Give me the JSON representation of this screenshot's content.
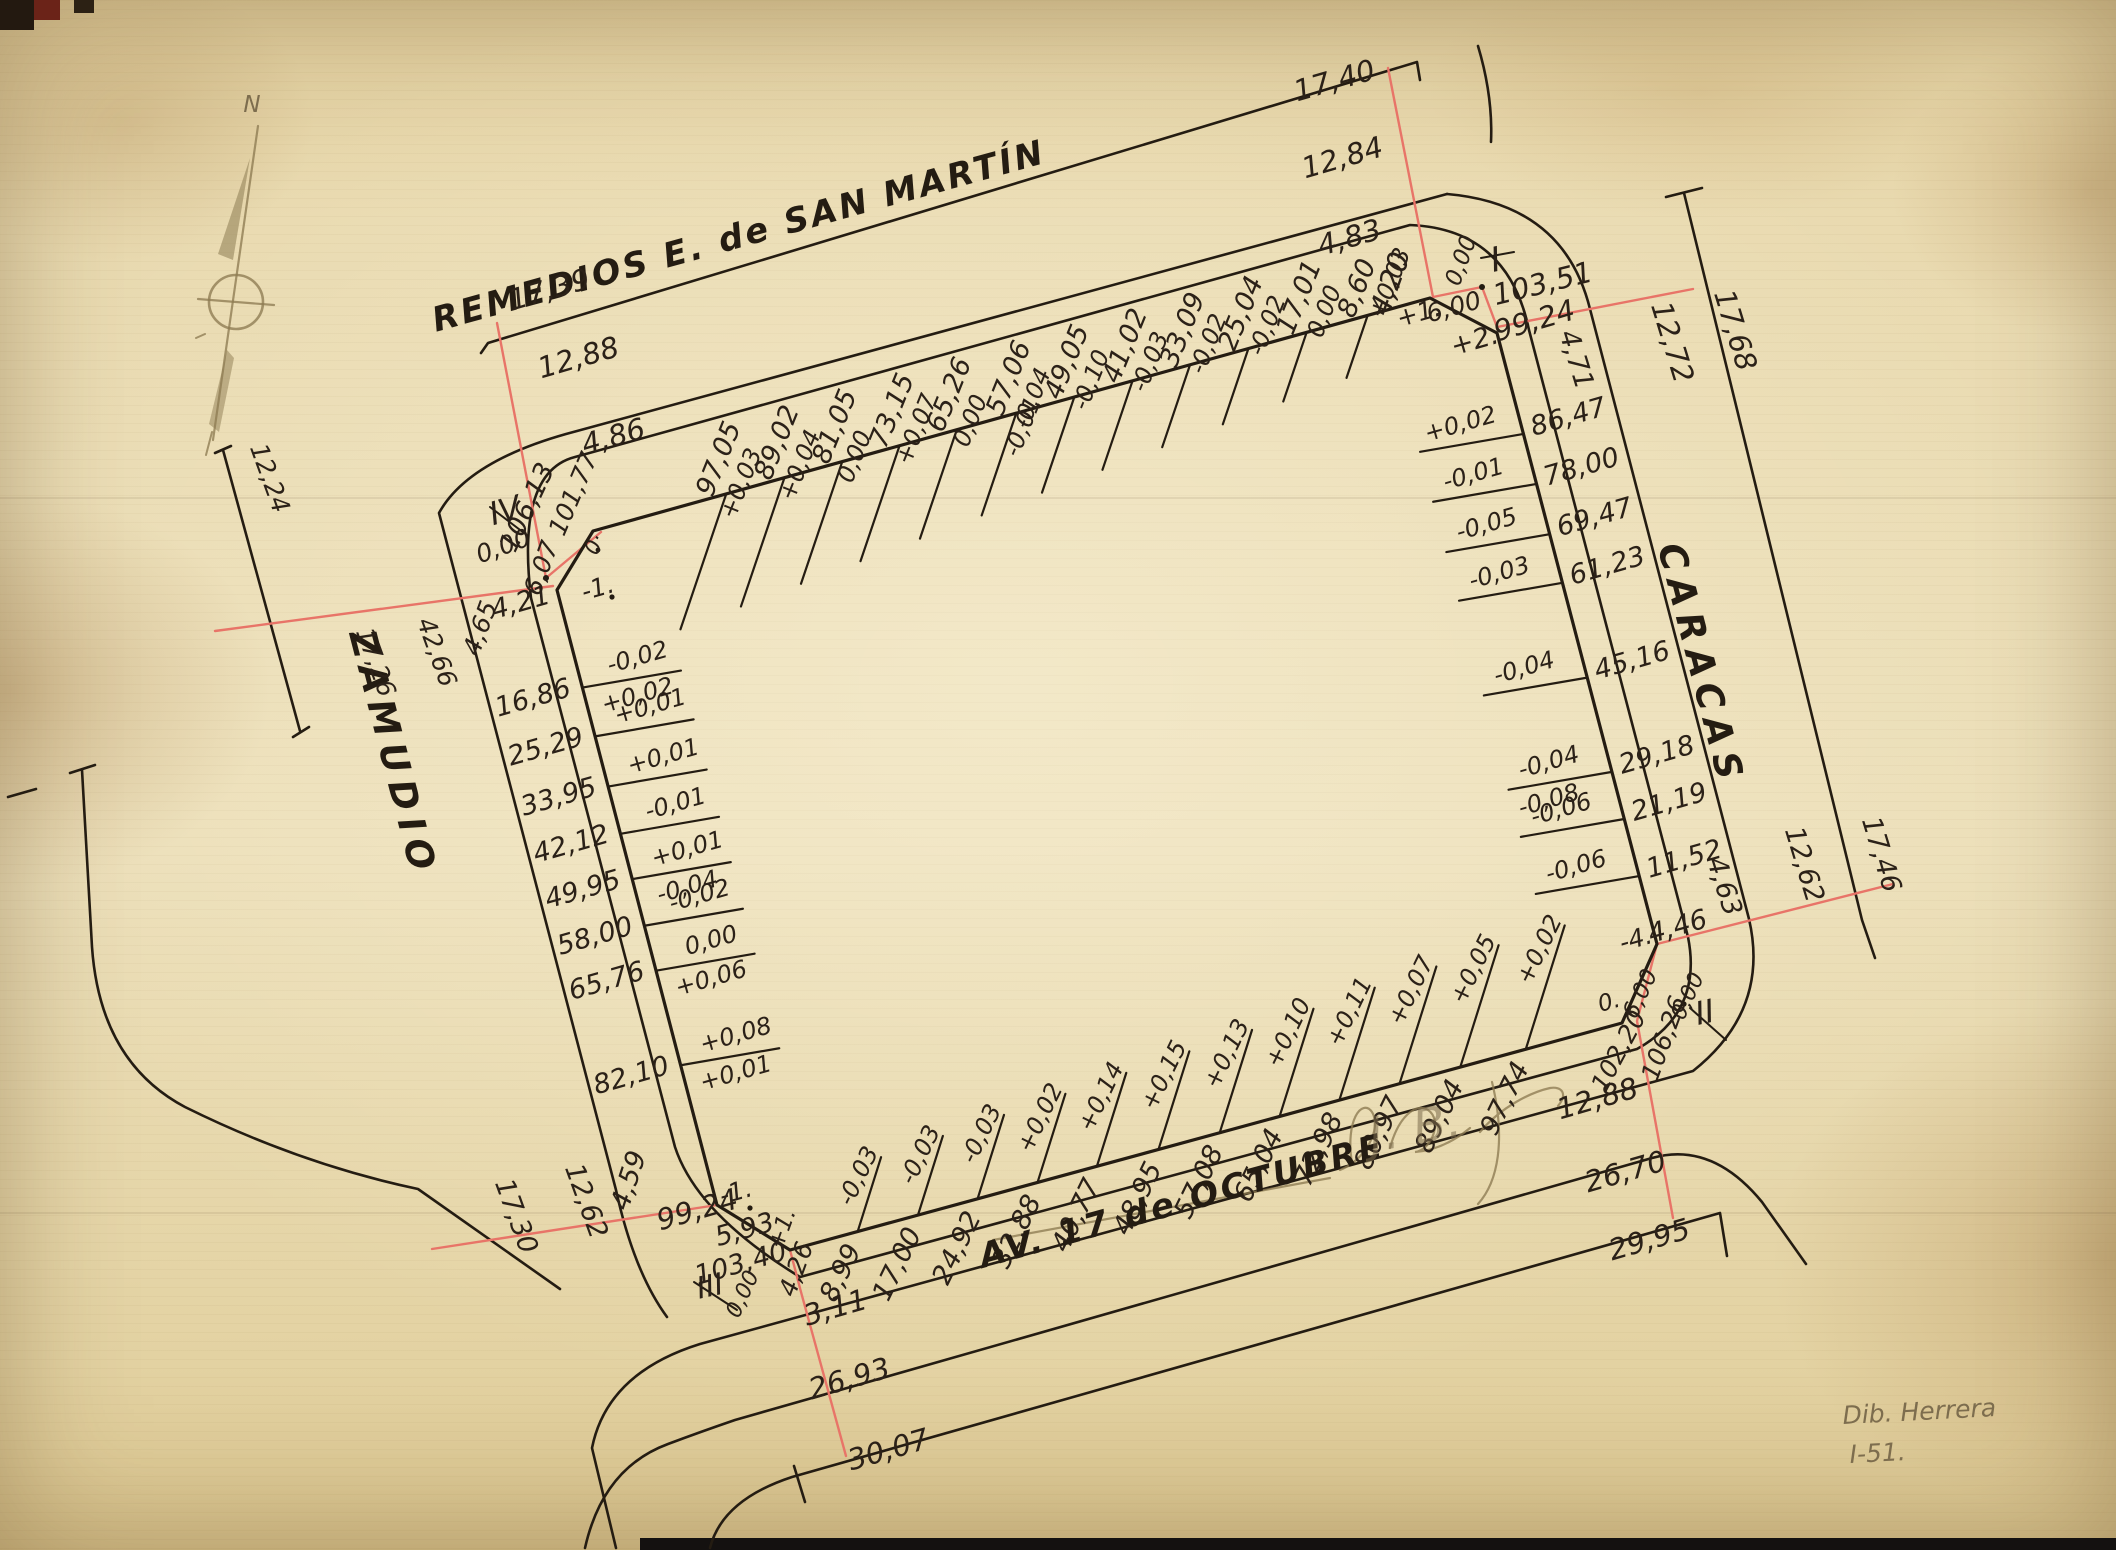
{
  "streets": {
    "top": "REMEDIOS E. de SAN MARTÍN",
    "right": "CARACAS",
    "left": "ZAMUDIO",
    "bottom": "AV. 17 de OCTUBRE"
  },
  "compass_north_label": "N",
  "edges": {
    "top": {
      "ticks": [
        {
          "d": "8,60",
          "c": "+0,03"
        },
        {
          "d": "17,01",
          "c": "0,00"
        },
        {
          "d": "25,04",
          "c": "-0,02"
        },
        {
          "d": "33,09",
          "c": "-0,02"
        },
        {
          "d": "41,02",
          "c": "-0,03"
        },
        {
          "d": "49,05",
          "c": "-0,10"
        },
        {
          "d": "57,06",
          "c": "-0,04",
          "c2": "-0,01"
        },
        {
          "d": "65,26",
          "c": "0,00"
        },
        {
          "d": "73,15",
          "c": "+0,07"
        },
        {
          "d": "81,05",
          "c": "0,00"
        },
        {
          "d": "89,02",
          "c": "+0,04"
        },
        {
          "d": "97,05",
          "c": "+0,03"
        }
      ]
    },
    "right": {
      "ticks": [
        {
          "d": "86,47",
          "c": "+0,02"
        },
        {
          "d": "78,00",
          "c": "-0,01"
        },
        {
          "d": "69,47",
          "c": "-0,05"
        },
        {
          "d": "61,23",
          "c": "-0,03"
        },
        {
          "d": "45,16",
          "c": "-0,04"
        },
        {
          "d": "29,18",
          "c": "-0,04",
          "c2": "-0,08"
        },
        {
          "d": "21,19",
          "c": "-0,06"
        },
        {
          "d": "11,52",
          "c": "-0,06"
        }
      ]
    },
    "bottom": {
      "ticks": [
        {
          "d": "8,99",
          "c": "-0,03"
        },
        {
          "d": "17,00",
          "c": "-0,03"
        },
        {
          "d": "24,92",
          "c": "-0,03"
        },
        {
          "d": "32,88",
          "c": "+0,02"
        },
        {
          "d": "40,77",
          "c": "+0,14"
        },
        {
          "d": "48,95",
          "c": "+0,15"
        },
        {
          "d": "57,08",
          "c": "+0,13"
        },
        {
          "d": "65,04",
          "c": "+0,10"
        },
        {
          "d": "72,98",
          "c": "+0,11"
        },
        {
          "d": "80,97",
          "c": "+0,07"
        },
        {
          "d": "89,04",
          "c": "+0,05"
        },
        {
          "d": "97,74",
          "c": "+0,02"
        }
      ]
    },
    "left": {
      "ticks": [
        {
          "d": "16,86",
          "c": "-0,02",
          "c2": "+0,02"
        },
        {
          "d": "25,29",
          "c": "+0,01"
        },
        {
          "d": "33,95",
          "c": "+0,01"
        },
        {
          "d": "42,12",
          "c": "-0,01"
        },
        {
          "d": "49,95",
          "c": "+0,01",
          "c2": "-0,04"
        },
        {
          "d": "58,00",
          "c": "-0,02"
        },
        {
          "d": "65,76",
          "c": "0,00",
          "c2": "+0,06"
        },
        {
          "d": "82,10",
          "c": "+0,08",
          "c2": "+0,01"
        }
      ]
    }
  },
  "corners": {
    "I": {
      "numeral": "I",
      "values": {
        "width_outer": "4,83",
        "offset": "4,20",
        "corr1": "+1.",
        "chamfer": "6,00",
        "zero": "0,00",
        "total_a": "103,51",
        "corr2": "+2.",
        "total_b": "99,24",
        "width_side": "4,71"
      }
    },
    "II": {
      "numeral": "II",
      "values": {
        "width_side": "4,63",
        "corr": "-4.",
        "chamfer": "4,46",
        "chamfer2": "6,00",
        "zero_dot": "0.",
        "zero": "0,00",
        "total_a": "106,26",
        "total_b": "102,20"
      }
    },
    "III": {
      "numeral": "III",
      "values": {
        "width_side": "4,59",
        "total_b": "99,24",
        "corr1": "-1.",
        "chamfer": "5,93",
        "total_a": "103,40",
        "zero": "0,00",
        "corr2": "+1.",
        "offset": "4,26",
        "width_outer": "3,11"
      }
    },
    "IV": {
      "numeral": "IV",
      "values": {
        "width_outer": "4,86",
        "total_b": "101,77",
        "station": "0·",
        "total_a": "106,13",
        "zero": "0,00",
        "chamfer": "6,07",
        "corr1": "-1.",
        "offset": "4,21",
        "width_side": "4,65"
      }
    }
  },
  "street_widths": {
    "top_left": {
      "far": "17,39",
      "mid": "12,88"
    },
    "top_right": {
      "far": "17,40",
      "mid": "12,84"
    },
    "right_top": {
      "far": "17,68",
      "mid": "12,72"
    },
    "right_bottom": {
      "far": "17,46",
      "mid": "12,62"
    },
    "bottom_right": {
      "mid": "12,88",
      "w26": "26,70",
      "w30": "29,95"
    },
    "bottom_left": {
      "far": "17,30",
      "mid": "12,62",
      "w26": "26,93",
      "w30": "30,07"
    },
    "left_top": {
      "far": "17,26",
      "mid": "12,24",
      "len": "42,66"
    }
  },
  "signature": {
    "line1": "Dib. Herrera",
    "line2": "I-51."
  },
  "handwriting": "J. B.",
  "colors": {
    "ink": "#2b2118",
    "red": "#e87468",
    "pencil": "#8d7b52",
    "paper": "#e8dab0"
  }
}
